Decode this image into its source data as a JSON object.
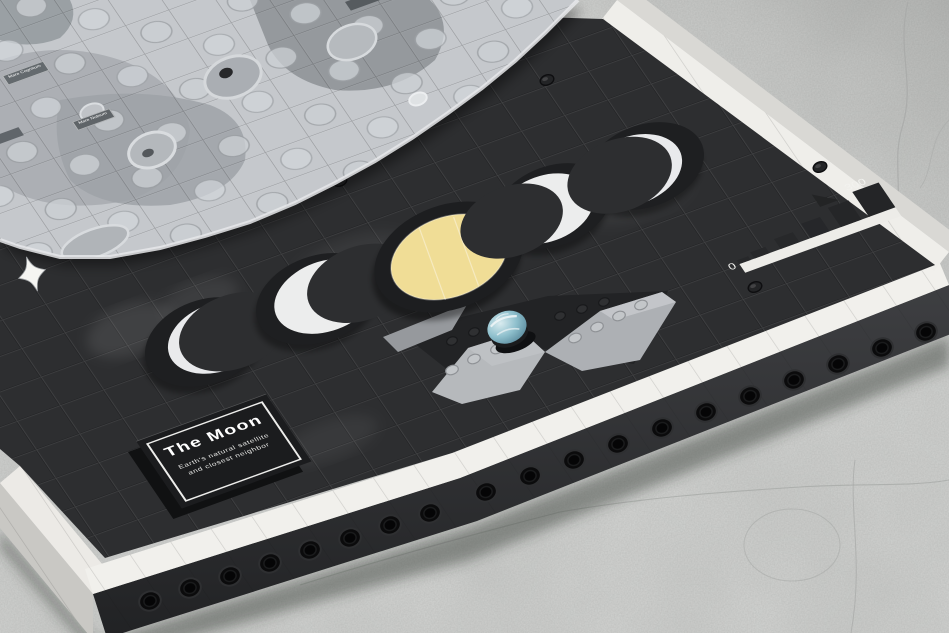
{
  "scene": {
    "description": "Brick-built wall-art model of the Moon lying on a cracked concrete surface",
    "subject": "The Moon LEGO-style art panel"
  },
  "plaque": {
    "title": "The Moon",
    "subtitle": "Earth's natural satellite and closest neighbor"
  },
  "scale_bar": {
    "start_label": "0",
    "end_label": "300"
  },
  "moon": {
    "labels": [
      "Mare Cognitum",
      "Mare Nubium"
    ]
  },
  "colors": {
    "board": "#2d2e30",
    "border_tiles": "#f1f0ec",
    "moon_surface": "#c5c8cc",
    "full_moon_accent": "#f0dd96",
    "earth": "#7fb3c3",
    "concrete": "#d6d7d5"
  }
}
